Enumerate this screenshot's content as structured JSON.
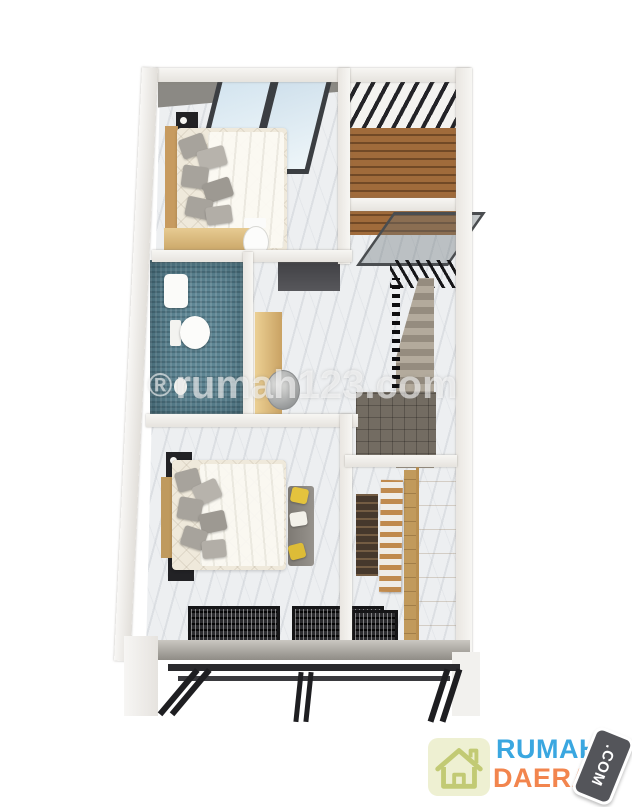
{
  "scene": {
    "kind": "3d-top-down-floorplan-render",
    "background": "#ffffff"
  },
  "watermark": {
    "symbol": "®",
    "text": "rumah123.com",
    "color": "#ffffff",
    "opacity": 0.58
  },
  "logo": {
    "word_top": "RUMAH",
    "word_bottom": "DAERAH",
    "badge": ".COM",
    "colors": {
      "word_top": "#3aa7e0",
      "word_bottom": "#f2854e",
      "badge_bg": "#54555a",
      "badge_text": "#ffffff",
      "icon_bg": "#eef0d2",
      "icon_stroke": "#c2ca74"
    }
  },
  "palette": {
    "outer_wall": "#f4f3f0",
    "wall_shadow": "#d8d5d0",
    "marble_floor": "#edeff1",
    "ceiling_band": "#8b8984",
    "window_glass": "#d3e4ef",
    "window_frame": "#3b3e42",
    "deck_wood": "#a06b3b",
    "pergola_slat": "#232327",
    "bathroom_mosaic": "#5e8694",
    "fixture_white": "#fbfbf9",
    "bedding": "#efe9db",
    "pillow_gray": "#a7a39c",
    "cabinet_wood": "#d9b578",
    "wardrobe_wood": "#e0c289",
    "stair_step": "#a59d92",
    "landing_gray": "#736c62",
    "facade_beam": "#1e1e21",
    "ledge_gray": "#9f9c96",
    "accent_yellow": "#e4c33d"
  }
}
